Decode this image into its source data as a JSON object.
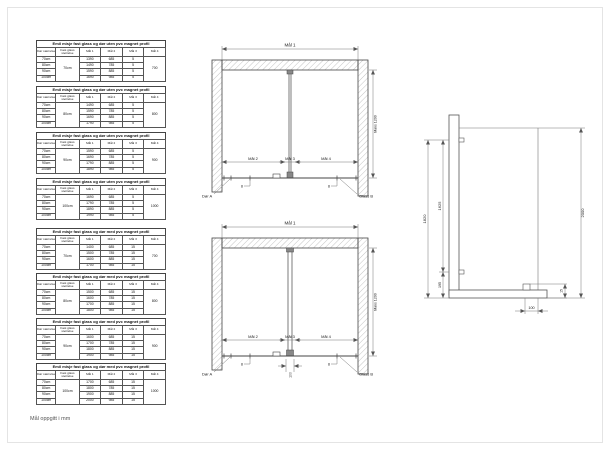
{
  "page": {
    "footnote": "Mål oppgitt i mm",
    "background": "#ffffff",
    "line_color": "#4d4d4d",
    "hatch_color": "#aaaaaa"
  },
  "table_group": {
    "headers": [
      "Dør størrelse",
      "Fast glass størrelse",
      "Mål 1",
      "Mål 2",
      "Mål 3",
      "Mål 4"
    ],
    "tables": [
      {
        "title": "Emil misje fast glass og dør uten pvc magnet profil",
        "glass_size": "70cm",
        "mal4": "700",
        "rows": [
          {
            "dor": "70cm",
            "mal1": "1390",
            "mal2": "685",
            "mal3": "5"
          },
          {
            "dor": "80cm",
            "mal1": "1490",
            "mal2": "785",
            "mal3": "5"
          },
          {
            "dor": "90cm",
            "mal1": "1590",
            "mal2": "885",
            "mal3": "5"
          },
          {
            "dor": "100cm",
            "mal1": "1690",
            "mal2": "985",
            "mal3": "5"
          }
        ]
      },
      {
        "title": "Emil misje fast glass og dør uten pvc magnet profil",
        "glass_size": "80cm",
        "mal4": "800",
        "rows": [
          {
            "dor": "70cm",
            "mal1": "1490",
            "mal2": "685",
            "mal3": "5"
          },
          {
            "dor": "80cm",
            "mal1": "1590",
            "mal2": "785",
            "mal3": "5"
          },
          {
            "dor": "90cm",
            "mal1": "1690",
            "mal2": "885",
            "mal3": "5"
          },
          {
            "dor": "100cm",
            "mal1": "1790",
            "mal2": "985",
            "mal3": "5"
          }
        ]
      },
      {
        "title": "Emil misje fast glass og dør uten pvc magnet profil",
        "glass_size": "90cm",
        "mal4": "900",
        "rows": [
          {
            "dor": "70cm",
            "mal1": "1590",
            "mal2": "685",
            "mal3": "5"
          },
          {
            "dor": "80cm",
            "mal1": "1690",
            "mal2": "785",
            "mal3": "5"
          },
          {
            "dor": "90cm",
            "mal1": "1790",
            "mal2": "885",
            "mal3": "5"
          },
          {
            "dor": "100cm",
            "mal1": "1890",
            "mal2": "985",
            "mal3": "5"
          }
        ]
      },
      {
        "title": "Emil misje fast glass og dør uten pvc magnet profil",
        "glass_size": "100cm",
        "mal4": "1000",
        "rows": [
          {
            "dor": "70cm",
            "mal1": "1690",
            "mal2": "685",
            "mal3": "5"
          },
          {
            "dor": "80cm",
            "mal1": "1790",
            "mal2": "785",
            "mal3": "5"
          },
          {
            "dor": "90cm",
            "mal1": "1890",
            "mal2": "885",
            "mal3": "5"
          },
          {
            "dor": "100cm",
            "mal1": "1990",
            "mal2": "985",
            "mal3": "5"
          }
        ]
      },
      {
        "title": "Emil misje fast glass og dør med pvc magnet profil",
        "glass_size": "70cm",
        "mal4": "700",
        "rows": [
          {
            "dor": "70cm",
            "mal1": "1400",
            "mal2": "685",
            "mal3": "15"
          },
          {
            "dor": "80cm",
            "mal1": "1500",
            "mal2": "785",
            "mal3": "15"
          },
          {
            "dor": "90cm",
            "mal1": "1600",
            "mal2": "885",
            "mal3": "15"
          },
          {
            "dor": "100cm",
            "mal1": "1700",
            "mal2": "985",
            "mal3": "15"
          }
        ]
      },
      {
        "title": "Emil misje fast glass og dør med pvc magnet profil",
        "glass_size": "80cm",
        "mal4": "800",
        "rows": [
          {
            "dor": "70cm",
            "mal1": "1500",
            "mal2": "685",
            "mal3": "15"
          },
          {
            "dor": "80cm",
            "mal1": "1600",
            "mal2": "785",
            "mal3": "15"
          },
          {
            "dor": "90cm",
            "mal1": "1700",
            "mal2": "885",
            "mal3": "15"
          },
          {
            "dor": "100cm",
            "mal1": "1800",
            "mal2": "985",
            "mal3": "15"
          }
        ]
      },
      {
        "title": "Emil misje fast glass og dør med pvc magnet profil",
        "glass_size": "90cm",
        "mal4": "900",
        "rows": [
          {
            "dor": "70cm",
            "mal1": "1600",
            "mal2": "685",
            "mal3": "15"
          },
          {
            "dor": "80cm",
            "mal1": "1700",
            "mal2": "785",
            "mal3": "15"
          },
          {
            "dor": "90cm",
            "mal1": "1800",
            "mal2": "885",
            "mal3": "15"
          },
          {
            "dor": "100cm",
            "mal1": "1900",
            "mal2": "985",
            "mal3": "15"
          }
        ]
      },
      {
        "title": "Emil misje fast glass og dør med pvc magnet profil",
        "glass_size": "100cm",
        "mal4": "1000",
        "rows": [
          {
            "dor": "70cm",
            "mal1": "1700",
            "mal2": "685",
            "mal3": "15"
          },
          {
            "dor": "80cm",
            "mal1": "1800",
            "mal2": "785",
            "mal3": "15"
          },
          {
            "dor": "90cm",
            "mal1": "1900",
            "mal2": "885",
            "mal3": "15"
          },
          {
            "dor": "100cm",
            "mal1": "2000",
            "mal2": "985",
            "mal3": "15"
          }
        ]
      }
    ]
  },
  "plan": {
    "dim_total": "Mål 1",
    "dim_max_height": "Maks 1200",
    "dim_door": "Mål 2",
    "dim_gap": "Mål 3",
    "dim_glass": "Mål 4",
    "door_label": "Dør A",
    "glass_label": "Glass B",
    "hinge_mark": "8",
    "center_width": "100"
  },
  "side_view": {
    "total_height": "2000",
    "wall_height": "1820",
    "glass_height": "1625",
    "bottom_bracket": "195",
    "floor_depth": "100",
    "profile_offset": "15"
  }
}
